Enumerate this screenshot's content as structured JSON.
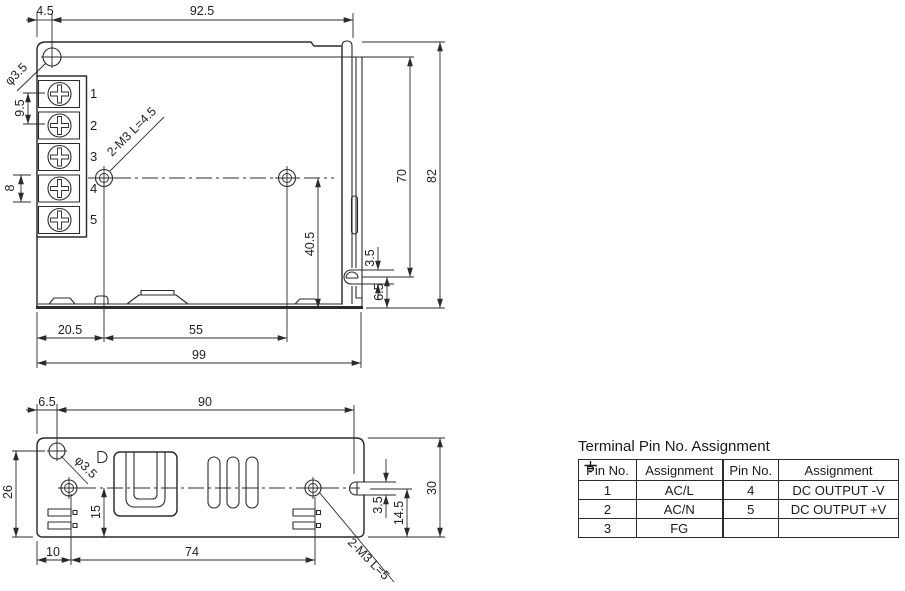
{
  "top_view": {
    "dims": {
      "width_offset": "4.5",
      "width_main": "92.5",
      "height_total": "82",
      "height_inner": "70",
      "hole_v": "40.5",
      "slot_w": "3.5",
      "slot_off": "6.5",
      "base_left": "20.5",
      "base_mid": "55",
      "base_total": "99",
      "term_pitch": "9.5",
      "term_height": "8"
    },
    "hole_label": "φ3.5",
    "screw_label": "2-M3 L=4.5",
    "terminal_numbers": [
      "1",
      "2",
      "3",
      "4",
      "5"
    ]
  },
  "side_view": {
    "dims": {
      "off_left": "6.5",
      "width_main": "90",
      "height_left": "26",
      "hole_v": "15",
      "base_left": "10",
      "base_mid": "74",
      "slot_w": "3.5",
      "slot_v": "14.5",
      "height_total": "30"
    },
    "hole_label": "φ3.5",
    "screw_label": "2-M3 L=5"
  },
  "pin_table": {
    "title": "Terminal Pin No. Assignment",
    "headers": [
      "Pin No.",
      "Assignment",
      "Pin No.",
      "Assignment"
    ],
    "rows": [
      [
        "1",
        "AC/L",
        "4",
        "DC OUTPUT -V"
      ],
      [
        "2",
        "AC/N",
        "5",
        "DC OUTPUT +V"
      ],
      [
        "3",
        "FG",
        "",
        ""
      ]
    ]
  }
}
